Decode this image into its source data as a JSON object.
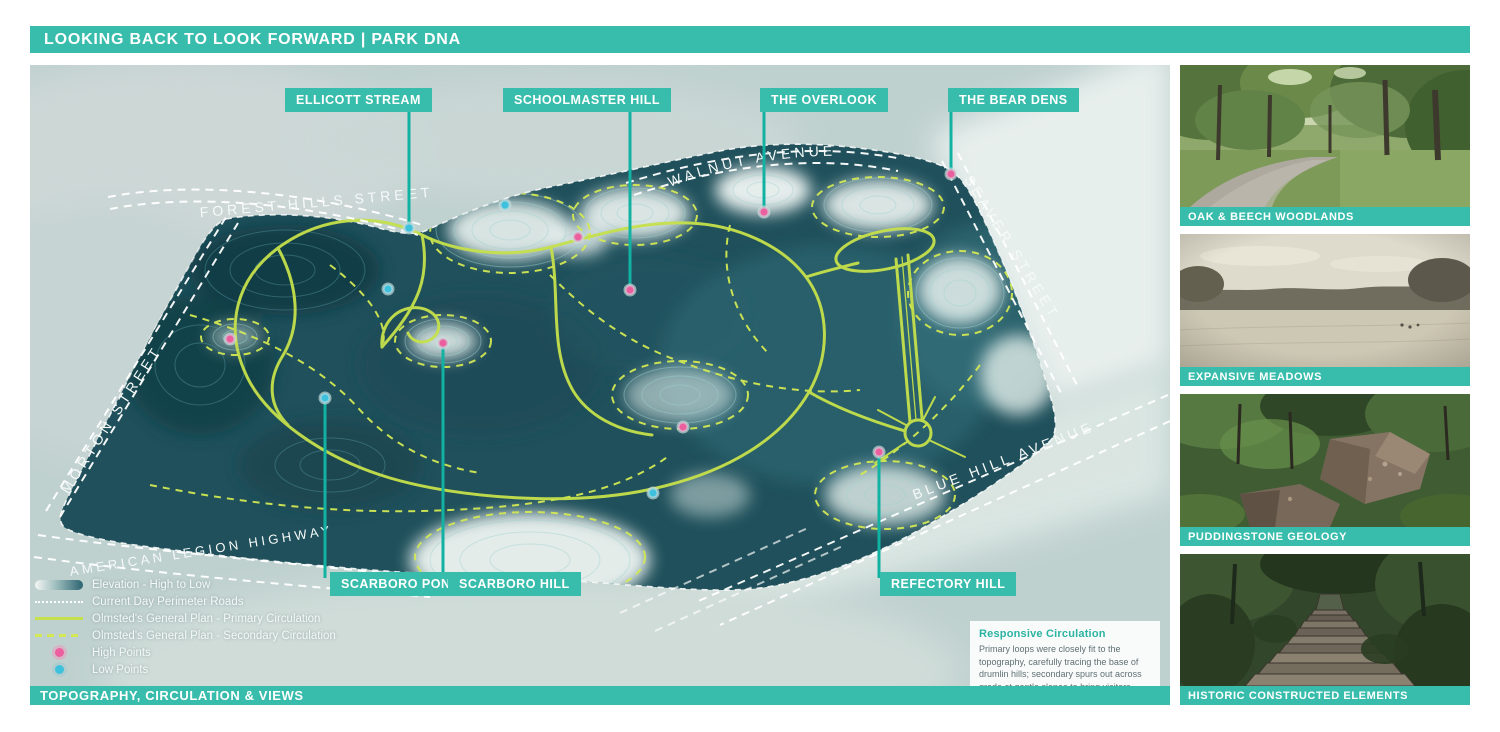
{
  "header": {
    "title": "LOOKING BACK TO LOOK FORWARD |  PARK DNA"
  },
  "map": {
    "features": [
      {
        "label": "ELLICOTT STREAM"
      },
      {
        "label": "SCHOOLMASTER HILL"
      },
      {
        "label": "THE OVERLOOK"
      },
      {
        "label": "THE BEAR DENS"
      },
      {
        "label": "SCARBORO POND"
      },
      {
        "label": "SCARBORO HILL"
      },
      {
        "label": "REFECTORY HILL"
      }
    ],
    "streets": {
      "forest_hills": "FOREST HILLS STREET",
      "walnut": "WALNUT   AVENUE",
      "morton": "MORTON STREET",
      "seaver": "SEAVER STREET",
      "blue_hill": "BLUE HILL AVENUE",
      "american_legion": "AMERICAN LEGION HIGHWAY"
    },
    "legend": {
      "items": [
        {
          "swatch": "elevation-gradient",
          "label": "Elevation - High to Low"
        },
        {
          "swatch": "dotted-white-line",
          "label": "Current Day Perimeter Roads"
        },
        {
          "swatch": "solid-yellow-line",
          "label": "Olmsted's General Plan - Primary Circulation"
        },
        {
          "swatch": "dashed-yellow-line",
          "label": "Olmsted's General Plan - Secondary Circulation"
        },
        {
          "swatch": "pink-dot",
          "label": "High Points"
        },
        {
          "swatch": "cyan-dot",
          "label": "Low Points"
        }
      ]
    },
    "note": {
      "title": "Responsive Circulation",
      "body": "Primary loops were closely fit to the topography, carefully tracing the base of drumlin hills; secondary spurs out across grade at gentle slopes to bring visitors from low to high points throughout the park."
    },
    "footer": "TOPOGRAPHY, CIRCULATION & VIEWS"
  },
  "sidebar": {
    "cards": [
      {
        "caption": "OAK & BEECH WOODLANDS"
      },
      {
        "caption": "EXPANSIVE MEADOWS"
      },
      {
        "caption": "PUDDINGSTONE GEOLOGY"
      },
      {
        "caption": "HISTORIC CONSTRUCTED ELEMENTS"
      }
    ]
  },
  "colors": {
    "teal": "#38bcab",
    "leader": "#12b2a3",
    "path_yellow": "#c6e04b",
    "high_point_pink": "#ec5f9f",
    "low_point_cyan": "#3ec1dd",
    "park_dark": "#1f505b"
  }
}
